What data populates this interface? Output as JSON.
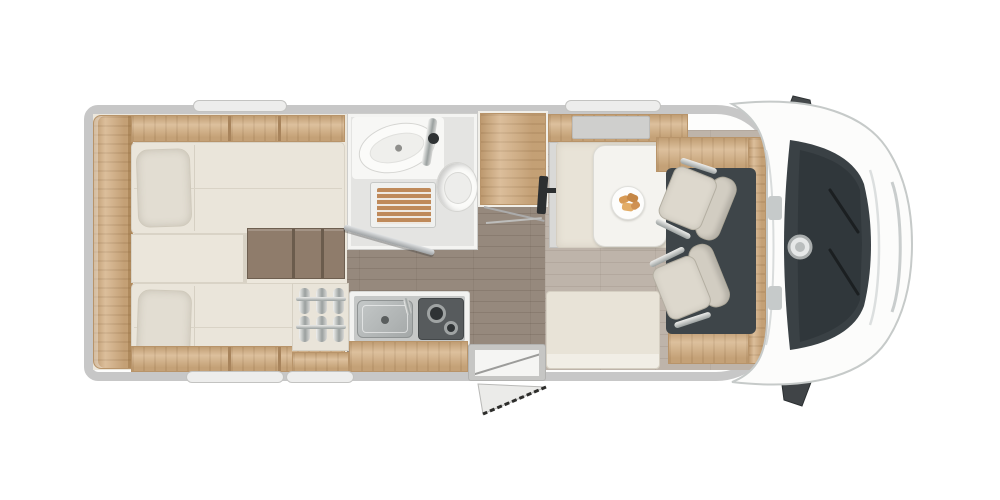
{
  "labels": {
    "stage": "Motorhome floor plan, top view, cab facing right",
    "rear_bedroom": "Rear twin single beds with steps and wardrobe shelves",
    "bathroom": "Bathroom with washbasin, shower tray and toilet",
    "wardrobe": "Wardrobe cabinet",
    "kitchen": "Kitchen block with sink, two-burner hob and bottle rack",
    "entrance": "Entrance door with fold-out entry step",
    "dinette": "Half dinette with table and two swivelled cab seats",
    "cab": "Driver cab with windshield, hood and exterior mirrors"
  },
  "zones": [
    {
      "name": "rear-twin-beds",
      "items": [
        "rear-shelf",
        "overhead-locker-top",
        "overhead-locker-bottom",
        "bed-top",
        "pillow-top",
        "bed-bottom",
        "pillow-bottom",
        "dresser",
        "bed-steps"
      ]
    },
    {
      "name": "bathroom",
      "items": [
        "washbasin",
        "faucet",
        "shower-tray",
        "toilet",
        "open-door"
      ]
    },
    {
      "name": "wardrobe",
      "items": [
        "wardrobe-cabinet",
        "door-swing-lines"
      ]
    },
    {
      "name": "kitchen",
      "items": [
        "bottle-rack",
        "counter",
        "sink",
        "two-burner-hob",
        "wood-front"
      ]
    },
    {
      "name": "entrance",
      "items": [
        "step-well",
        "fold-out-step"
      ]
    },
    {
      "name": "dinette",
      "items": [
        "overhead-locker",
        "sideboard",
        "tv-bracket",
        "bench-rear",
        "table",
        "plate-with-food",
        "bench-front",
        "side-panel-top",
        "side-panel-bottom"
      ]
    },
    {
      "name": "cab",
      "items": [
        "cab-floor",
        "driver-swivel-seat",
        "passenger-swivel-seat",
        "dashboard",
        "badge-ring",
        "windshield",
        "wipers",
        "hood",
        "mirror-top",
        "mirror-bottom"
      ]
    }
  ],
  "palette": {
    "background": "#ffffff",
    "wall": "#c7c7c7",
    "window": "#ededec",
    "wood_light": "#d4b085",
    "wood_steps": "#8f7c6b",
    "upholstery": "#e8e3d7",
    "seat": "#ddd8cd",
    "floor_corridor": "#96897d",
    "floor_lounge": "#beb4aa",
    "bathroom_floor": "#e4e4e2",
    "fixture_white": "#fbfbf9",
    "chrome": "#9aa09f",
    "cab_floor": "#3e4549",
    "windshield": "#3a4145",
    "mirror": "#45494b",
    "food": "#d79a55"
  }
}
